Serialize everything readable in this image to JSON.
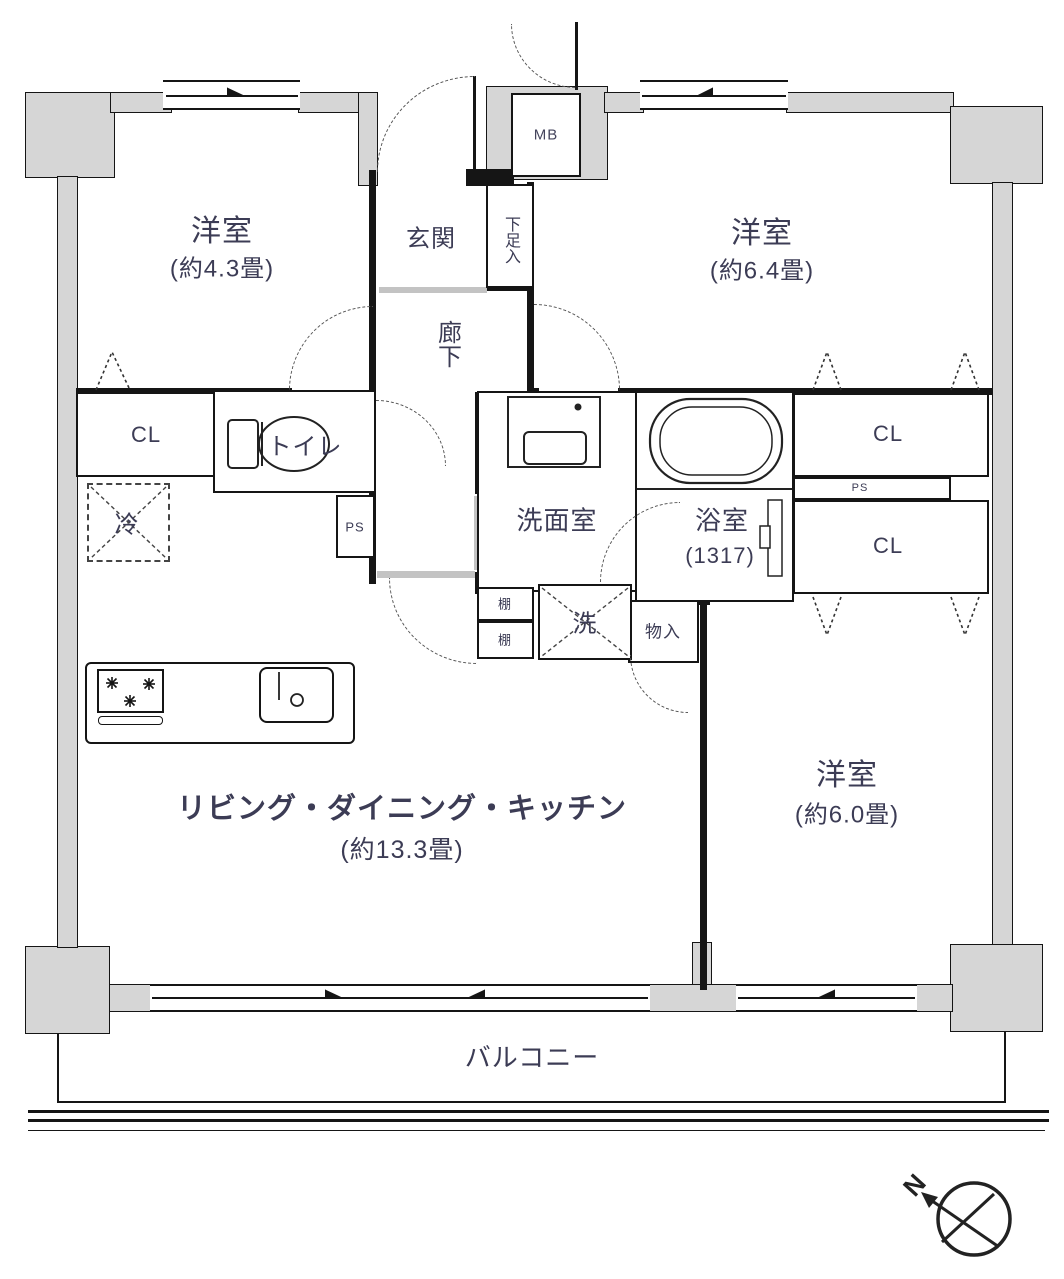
{
  "floor_plan": {
    "rooms": {
      "western_room_1": {
        "name": "洋室",
        "size": "(約4.3畳)"
      },
      "western_room_2": {
        "name": "洋室",
        "size": "(約6.4畳)"
      },
      "western_room_3": {
        "name": "洋室",
        "size": "(約6.0畳)"
      },
      "ldk": {
        "name": "リビング・ダイニング・キッチン",
        "size": "(約13.3畳)"
      },
      "entrance": {
        "name": "玄関"
      },
      "shoe_cabinet": {
        "name": "下足入"
      },
      "corridor": {
        "name": "廊下"
      },
      "washroom": {
        "name": "洗面室"
      },
      "bathroom": {
        "name": "浴室",
        "size": "(1317)"
      },
      "toilet": {
        "name": "トイレ"
      },
      "storage": {
        "name": "物入"
      },
      "balcony": {
        "name": "バルコニー"
      }
    },
    "labels": {
      "meter_box": "MB",
      "closet": "CL",
      "pipe_space": "PS",
      "refrigerator": "冷",
      "washing_machine": "洗",
      "shelf": "棚",
      "north": "N"
    },
    "colors": {
      "wall": "#151515",
      "wall_fill": "#d6d6d6",
      "text": "#3c3c55"
    }
  }
}
